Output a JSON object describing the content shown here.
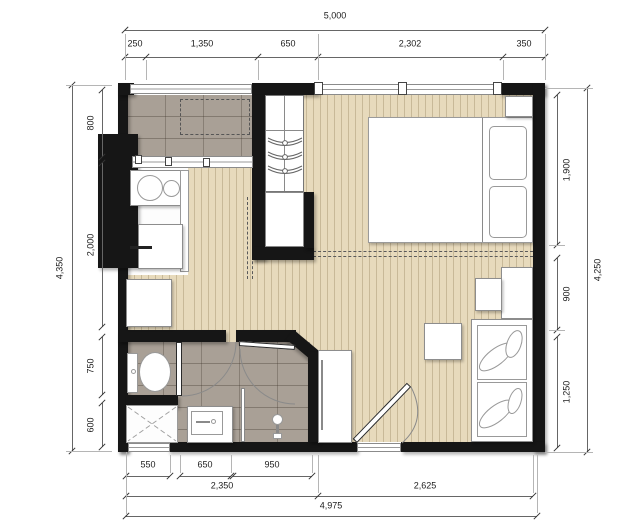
{
  "plan_type": "studio-apartment-floor-plan",
  "colors": {
    "wall": "#161616",
    "wood_floor": "#e7dabc",
    "tile_floor": "#a9a096",
    "fixture_fill": "#ffffff",
    "dimension_line": "#666666",
    "background": "#ffffff"
  },
  "dimensions": {
    "top": {
      "overall": "5,000",
      "segments": [
        "250",
        "1,350",
        "650",
        "2,302",
        "350"
      ]
    },
    "left": {
      "overall": "4,350",
      "segments": [
        "800",
        "2,000",
        "750",
        "600"
      ]
    },
    "right": {
      "overall": "4,250",
      "segments": [
        "1,900",
        "900",
        "1,250"
      ]
    },
    "bottom": {
      "overall": "4,975",
      "segments_inner": [
        "550",
        "650",
        "950"
      ],
      "segments_mid": [
        "2,350",
        "2,625"
      ]
    }
  },
  "fixtures": [
    "balcony-tiled-floor",
    "ac-unit-dashed-outline",
    "balcony-railing-window",
    "kitchen-counter-with-sink-and-hob",
    "refrigerator",
    "washing-machine",
    "sliding-window",
    "wardrobe-with-hangers",
    "storage-cabinet",
    "double-bed-with-pillows",
    "nightstand",
    "bedroom-window",
    "desk",
    "chair",
    "coffee-table",
    "sofa-with-leaf-cushions",
    "toilet",
    "shower-stall",
    "wash-basin",
    "floor-mixer-tap",
    "glass-partition",
    "bathroom-door",
    "toilet-door",
    "entrance-door",
    "shoe-cabinet",
    "entrance-threshold",
    "shower-window"
  ]
}
